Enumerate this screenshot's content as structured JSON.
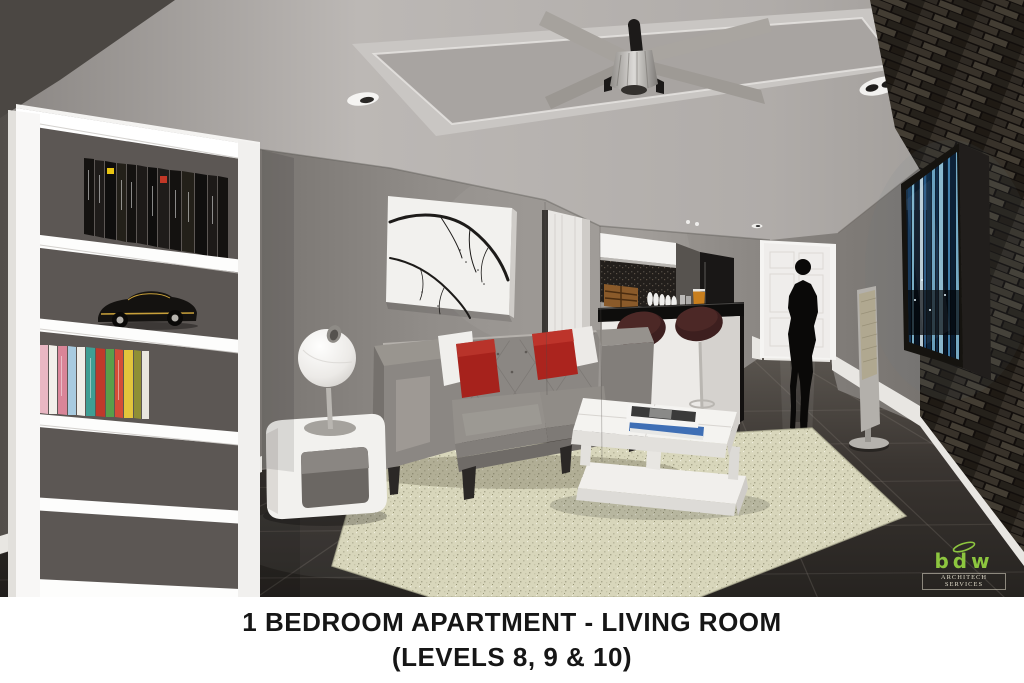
{
  "render": {
    "type": "3D architectural interior visualization",
    "room": "open-plan living room with kitchen bar and hallway"
  },
  "caption": {
    "line1": "1 BEDROOM APARTMENT - LIVING ROOM",
    "line2": "(LEVELS 8, 9 & 10)",
    "text_color": "#161616",
    "background": "#ffffff"
  },
  "logo": {
    "brand": "bdw",
    "tagline": "ARCHITECH SERVICES",
    "brand_color": "#8dc63f",
    "tagline_color": "#ded9c8"
  },
  "scene": {
    "objects": [
      "white bookshelf with black books, colorful books and black toy muscle car",
      "branch artwork on white canvas",
      "gray tufted sofa with red and white pillows",
      "white two-tier coffee table with two magazines",
      "cream speckled area rug",
      "white side table with white sphere lamp",
      "kitchen bar with black countertop and white base",
      "two dark maroon bar stools with chrome pedestals",
      "white upper cabinets and dark mosaic backsplash",
      "black refrigerator",
      "white paneled hallway door",
      "black walking person silhouette",
      "floor-standing tower speaker",
      "dark stacked-stone feature wall",
      "wall-mounted TV showing blue night city scene",
      "ceiling fan on recessed tray ceiling",
      "recessed downlights",
      "dark glossy floor tiles with white baseboards"
    ],
    "book_spines_partially_legible": [
      "FERRARI",
      "LUXURY AIRPORTS",
      "LUXURY HOTELS",
      "AMERICA",
      "NEW YORK"
    ],
    "colors": {
      "wall_gray": "#8e8a86",
      "dark_corner_wall": "#4b4743",
      "ceiling": "#b4b0ad",
      "floor_tile": "#332f2b",
      "rug": "#d8d6bb",
      "sofa_gray": "#8b8783",
      "pillow_red": "#a6221c",
      "stool_maroon": "#3d1f1f",
      "stone_wall": "#2b2620",
      "tv_glow_cyan": "#8cc8e2",
      "furniture_white": "#f2f1ee",
      "toy_car_stripe": "#c8a03a"
    }
  }
}
